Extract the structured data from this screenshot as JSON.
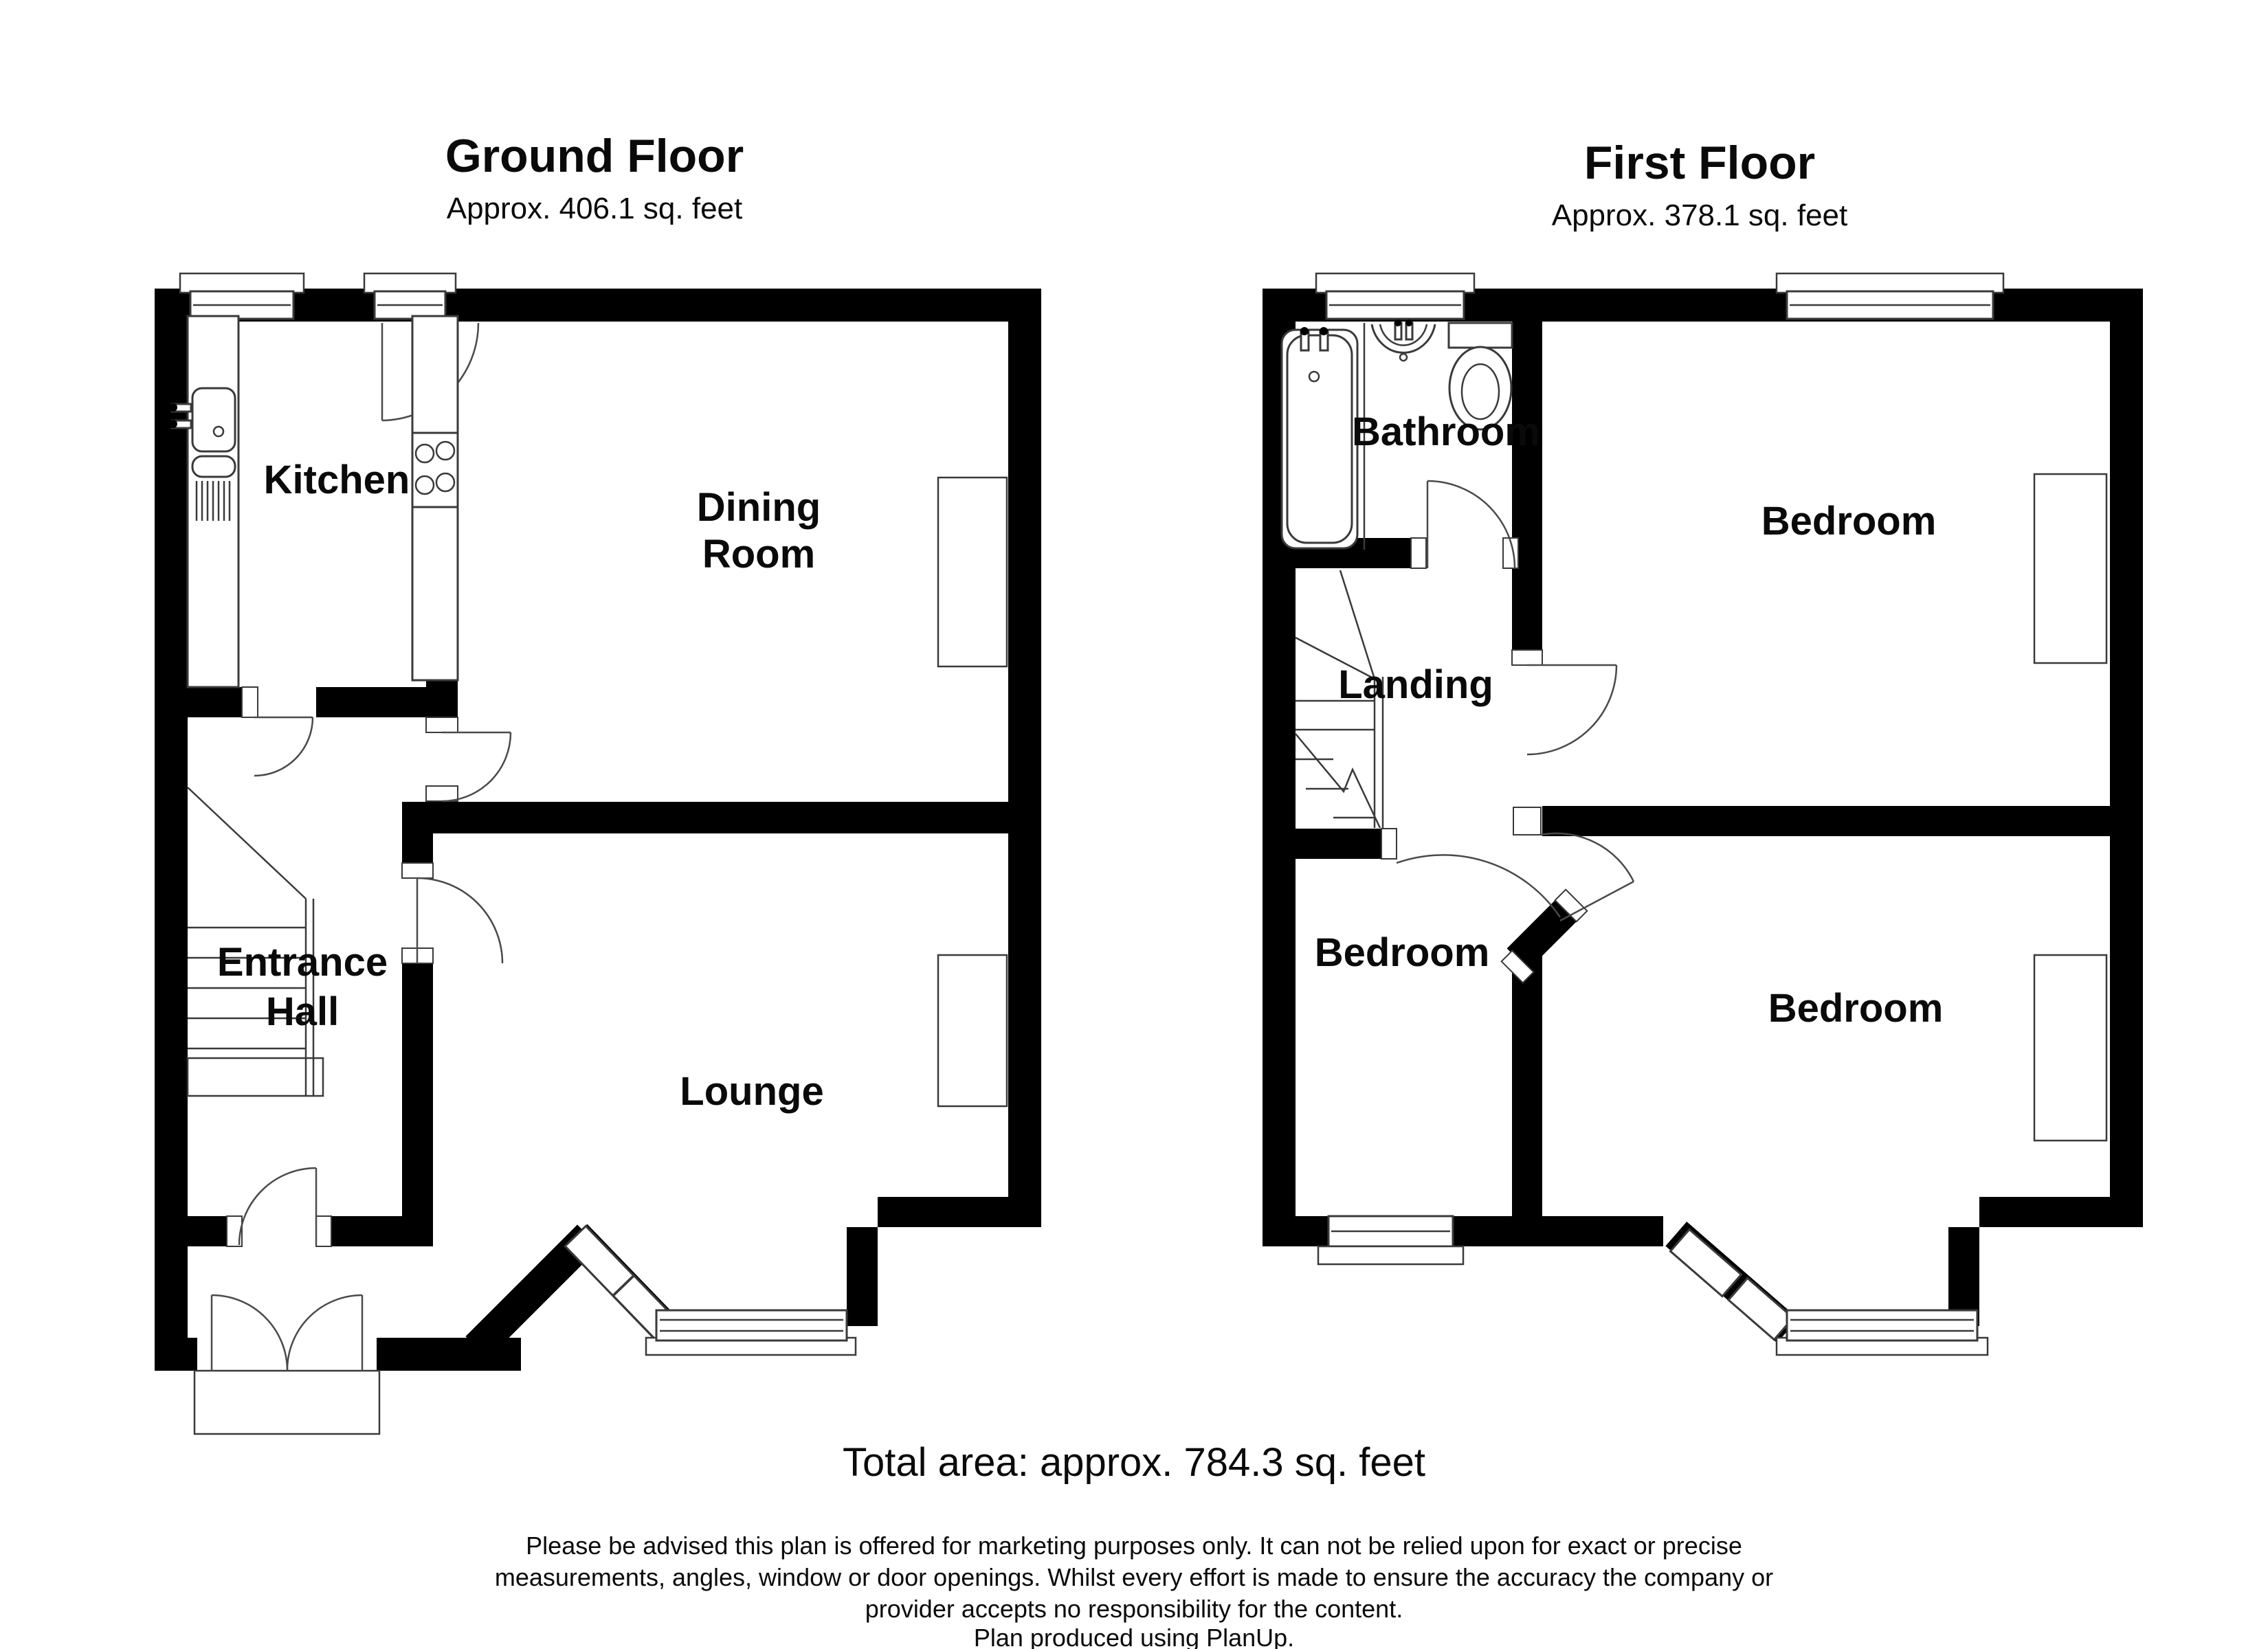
{
  "ground_floor": {
    "title": "Ground Floor",
    "area": "Approx. 406.1 sq. feet",
    "rooms": {
      "kitchen": "Kitchen",
      "dining_line1": "Dining",
      "dining_line2": "Room",
      "hall_line1": "Entrance",
      "hall_line2": "Hall",
      "lounge": "Lounge"
    }
  },
  "first_floor": {
    "title": "First Floor",
    "area": "Approx. 378.1 sq. feet",
    "rooms": {
      "bathroom": "Bathroom",
      "landing": "Landing",
      "bedroom_front": "Bedroom",
      "bedroom_small": "Bedroom",
      "bedroom_back": "Bedroom"
    }
  },
  "footer": {
    "total_area": "Total area: approx. 784.3 sq. feet",
    "disclaimer_line1": "Please be advised this plan is offered for marketing purposes only. It can not be relied upon for exact or precise",
    "disclaimer_line2": "measurements, angles, window or door openings. Whilst every effort is made to ensure the accuracy the company or",
    "disclaimer_line3": "provider accepts no responsibility for the content.",
    "disclaimer_line4": "Plan produced using PlanUp."
  },
  "colors": {
    "wall": "#000000",
    "line": "#3a3a3a",
    "background": "#ffffff"
  }
}
